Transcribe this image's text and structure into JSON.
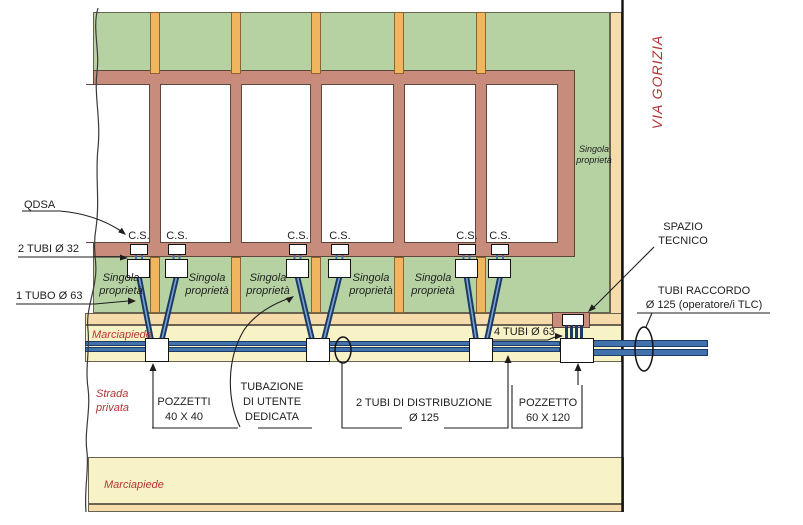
{
  "colors": {
    "green": "#b6d2a2",
    "wall": "#c78c7b",
    "wall-edge": "#5f463a",
    "post": "#f1b55f",
    "post-edge": "#8a6530",
    "tan": "#f6dcaa",
    "pave": "#f8f3c6",
    "edge": "#6b6352",
    "tube-dark": "#1b3a66",
    "tube-fill": "#4172ae",
    "tube-light": "#7ba3d4",
    "red": "#b23535",
    "ink": "#1e1e1e",
    "box-edge": "#141414"
  },
  "street": {
    "via_gorizia": "VIA GORIZIA"
  },
  "zones": {
    "singola_line1": "Singola",
    "singola_line2": "proprietà",
    "marciapiede_top": "Marciapiede",
    "strada_line1": "Strada",
    "strada_line2": "privata",
    "marciapiede_bottom": "Marciapiede"
  },
  "cs": [
    "C.S.",
    "C.S.",
    "C.S.",
    "C.S.",
    "C.S.",
    "C.S."
  ],
  "callouts": {
    "qdsa": "QDSA",
    "tubi_32": "2 TUBI Ø 32",
    "tubo_63": "1 TUBO Ø 63",
    "pozzetti_line1": "POZZETTI",
    "pozzetti_line2": "40 X 40",
    "tubazione_line1": "TUBAZIONE",
    "tubazione_line2": "DI UTENTE",
    "tubazione_line3": "DEDICATA",
    "distribuzione_line1": "2 TUBI DI DISTRIBUZIONE",
    "distribuzione_line2": "Ø 125",
    "pozzetto_line1": "POZZETTO",
    "pozzetto_line2": "60 X 120",
    "tubi_4": "4 TUBI Ø 63",
    "spazio_line1": "SPAZIO",
    "spazio_line2": "TECNICO",
    "raccordo_line1": "TUBI RACCORDO",
    "raccordo_line2": "Ø 125 (operatore/i TLC)"
  }
}
